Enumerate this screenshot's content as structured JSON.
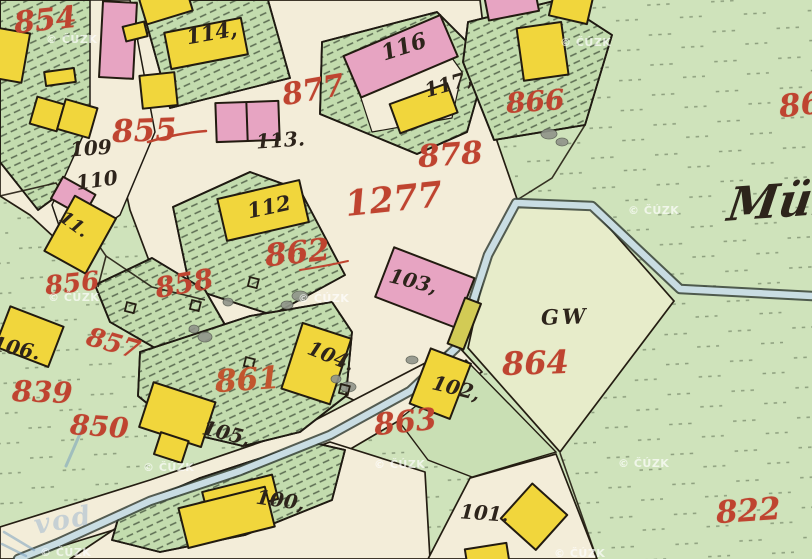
{
  "map": {
    "source_watermark": "© ČÚZK",
    "corner_watermark": "vod",
    "stream_name_fragment": "Mül",
    "land_use_label": "GW",
    "parcel_numbers_red": [
      "854",
      "855",
      "877",
      "878",
      "866",
      "86",
      "1277",
      "862",
      "858",
      "856",
      "857",
      "839",
      "850",
      "861",
      "863",
      "864",
      "822"
    ],
    "house_numbers_black": [
      "114,",
      "116",
      "117,",
      "113.",
      "109",
      "110",
      "11.",
      "112",
      "103,",
      "104.",
      "105,",
      "102,",
      "100,",
      "101.",
      "106."
    ],
    "legend_colors": {
      "masonry_building": "#e7a4c2",
      "wooden_building": "#f1d63c",
      "meadow_green": "#cfe3bb",
      "garden_green": "#c3dcae",
      "pale_parcel": "#e7ecca",
      "road_cream": "#f3edd9",
      "water_blue": "#c9dde3",
      "parcel_number_ink": "#bf4430",
      "house_number_ink": "#2d241b"
    }
  }
}
